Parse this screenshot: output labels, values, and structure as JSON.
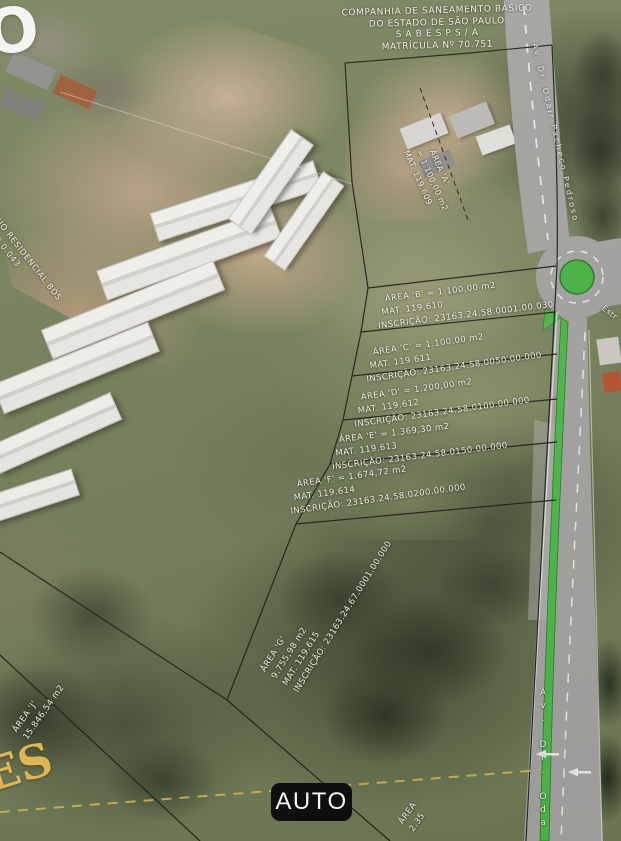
{
  "camera": {
    "mode_label": "AUTO"
  },
  "title_block": {
    "line1": "COMPANHIA DE SANEAMENTO BÁSICO",
    "line2": "DO ESTADO DE SÃO PAULO",
    "line3": "S A B E S P   S / A",
    "line4": "MATRÍCULA Nº  70.751"
  },
  "parcels": {
    "a": {
      "l1": "ÁREA 'A'",
      "l2": "= 1.100,00 m2",
      "l3": "MAT. 119.609"
    },
    "b": {
      "l1": "ÁREA 'B' = 1.100,00 m2",
      "l2": "MAT. 119.610",
      "l3": "INSCRIÇÃO: 23163.24.58.0001.00.030"
    },
    "c": {
      "l1": "ÁREA 'C' = 1.100,00 m2",
      "l2": "MAT. 119.611",
      "l3": "INSCRIÇÃO: 23163.24.58.0050.00.000"
    },
    "d": {
      "l1": "ÁREA 'D' = 1.200,00 m2",
      "l2": "MAT. 119.612",
      "l3": "INSCRIÇÃO: 23163.24.58.0100.00.000"
    },
    "e": {
      "l1": "ÁREA 'E' = 1.369,30 m2",
      "l2": "MAT. 119.613",
      "l3": "INSCRIÇÃO: 23163.24.58.0150.00.000"
    },
    "f": {
      "l1": "ÁREA 'F' = 1.674,72 m2",
      "l2": "MAT. 119.614",
      "l3": "INSCRIÇÃO: 23163.24.58.0200.00.000"
    },
    "g": {
      "l1": "ÁREA 'G'",
      "l2": "9.755,98 m2",
      "l3": "MAT. 119.615",
      "l4": "INSCRIÇÃO: 23163.24.67.0001.00.000"
    },
    "j": {
      "l1": "ÁREA 'J'",
      "l2": "15.846,54 m2"
    },
    "h": {
      "l1": "ÁREA",
      "l2": "2.35"
    }
  },
  "neighbor_label": {
    "line1": "CONDOMÍNIO RESIDENCIAL BOS",
    "line2": "MATRÍCULA Nº 0.043"
  },
  "streets": {
    "avenue_top": "Av. Dr. Odair Pacheco Pedroso",
    "avenue_bottom": "Av. Dr. Oda",
    "road_fragment": "Estr"
  },
  "watermarks": {
    "top_left": "O",
    "bottom_left": "ES"
  },
  "colors": {
    "median_green": "#4db848",
    "roundabout_green": "#49b342",
    "boundary_black": "#23231d",
    "utility_yellow": "#d9b84a",
    "badge_bg": "#0d0d0d",
    "road_gray": "#a4a3a0"
  }
}
